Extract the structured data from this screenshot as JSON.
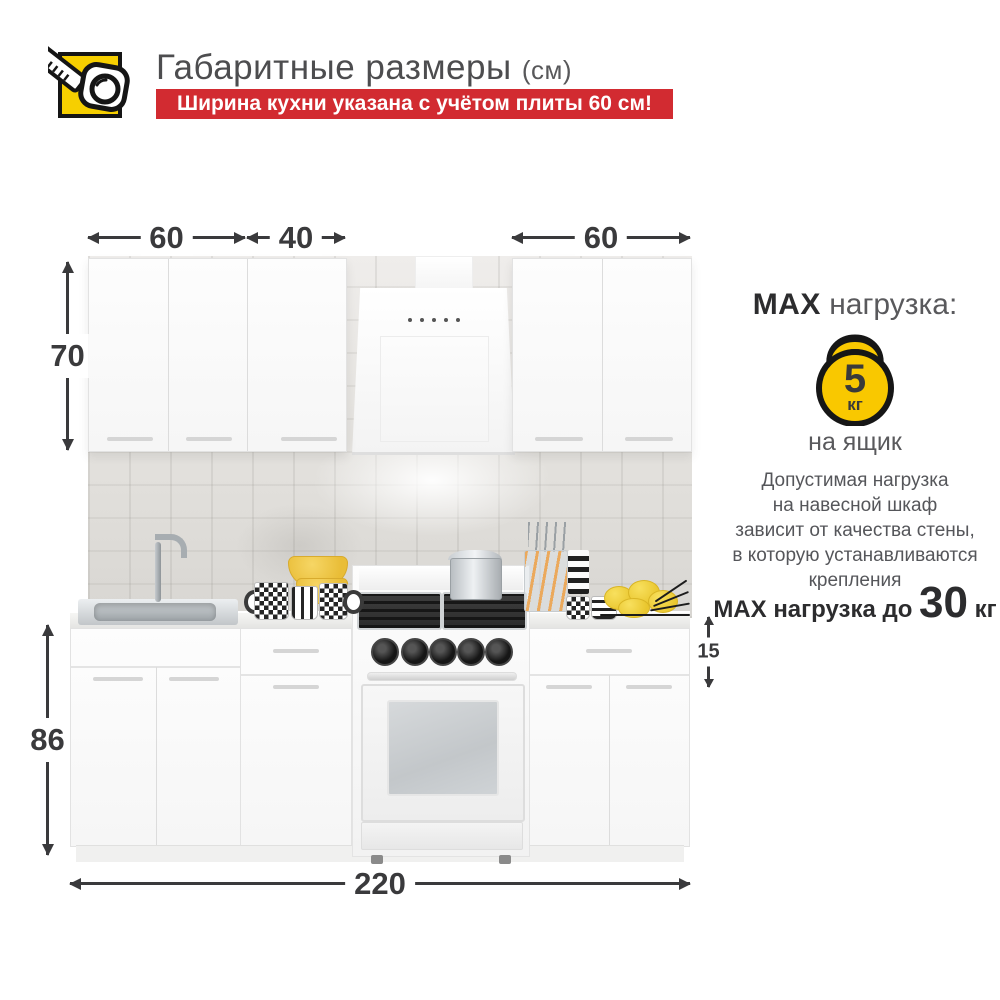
{
  "header": {
    "title": "Габаритные размеры",
    "unit": "(см)",
    "banner": "Ширина кухни указана с учётом плиты 60 см!"
  },
  "icons": {
    "header_icon": "tape-measure-icon",
    "load_icon": "kettlebell-icon"
  },
  "dimensions": {
    "top_left_width": "60",
    "top_middle_width": "40",
    "top_right_width": "60",
    "wall_cabinet_height": "70",
    "base_cabinet_height": "86",
    "drawer_height": "15",
    "total_width": "220"
  },
  "max_load": {
    "title_bold": "MAX",
    "title_rest": " нагрузка:",
    "kettlebell_value": "5",
    "kettlebell_unit": "кг",
    "per_drawer": "на ящик",
    "note_lines": [
      "Допустимая нагрузка",
      "на навесной шкаф",
      "зависит от качества стены,",
      "в которую устанавливаются",
      "крепления"
    ],
    "wall_prefix": "MAX нагрузка до ",
    "wall_value": "30",
    "wall_unit": " кг"
  },
  "colors": {
    "accent_red": "#d22b31",
    "accent_yellow": "#f6cf00",
    "dimension_text": "#3a3a3c",
    "gray_text": "#58595b"
  }
}
